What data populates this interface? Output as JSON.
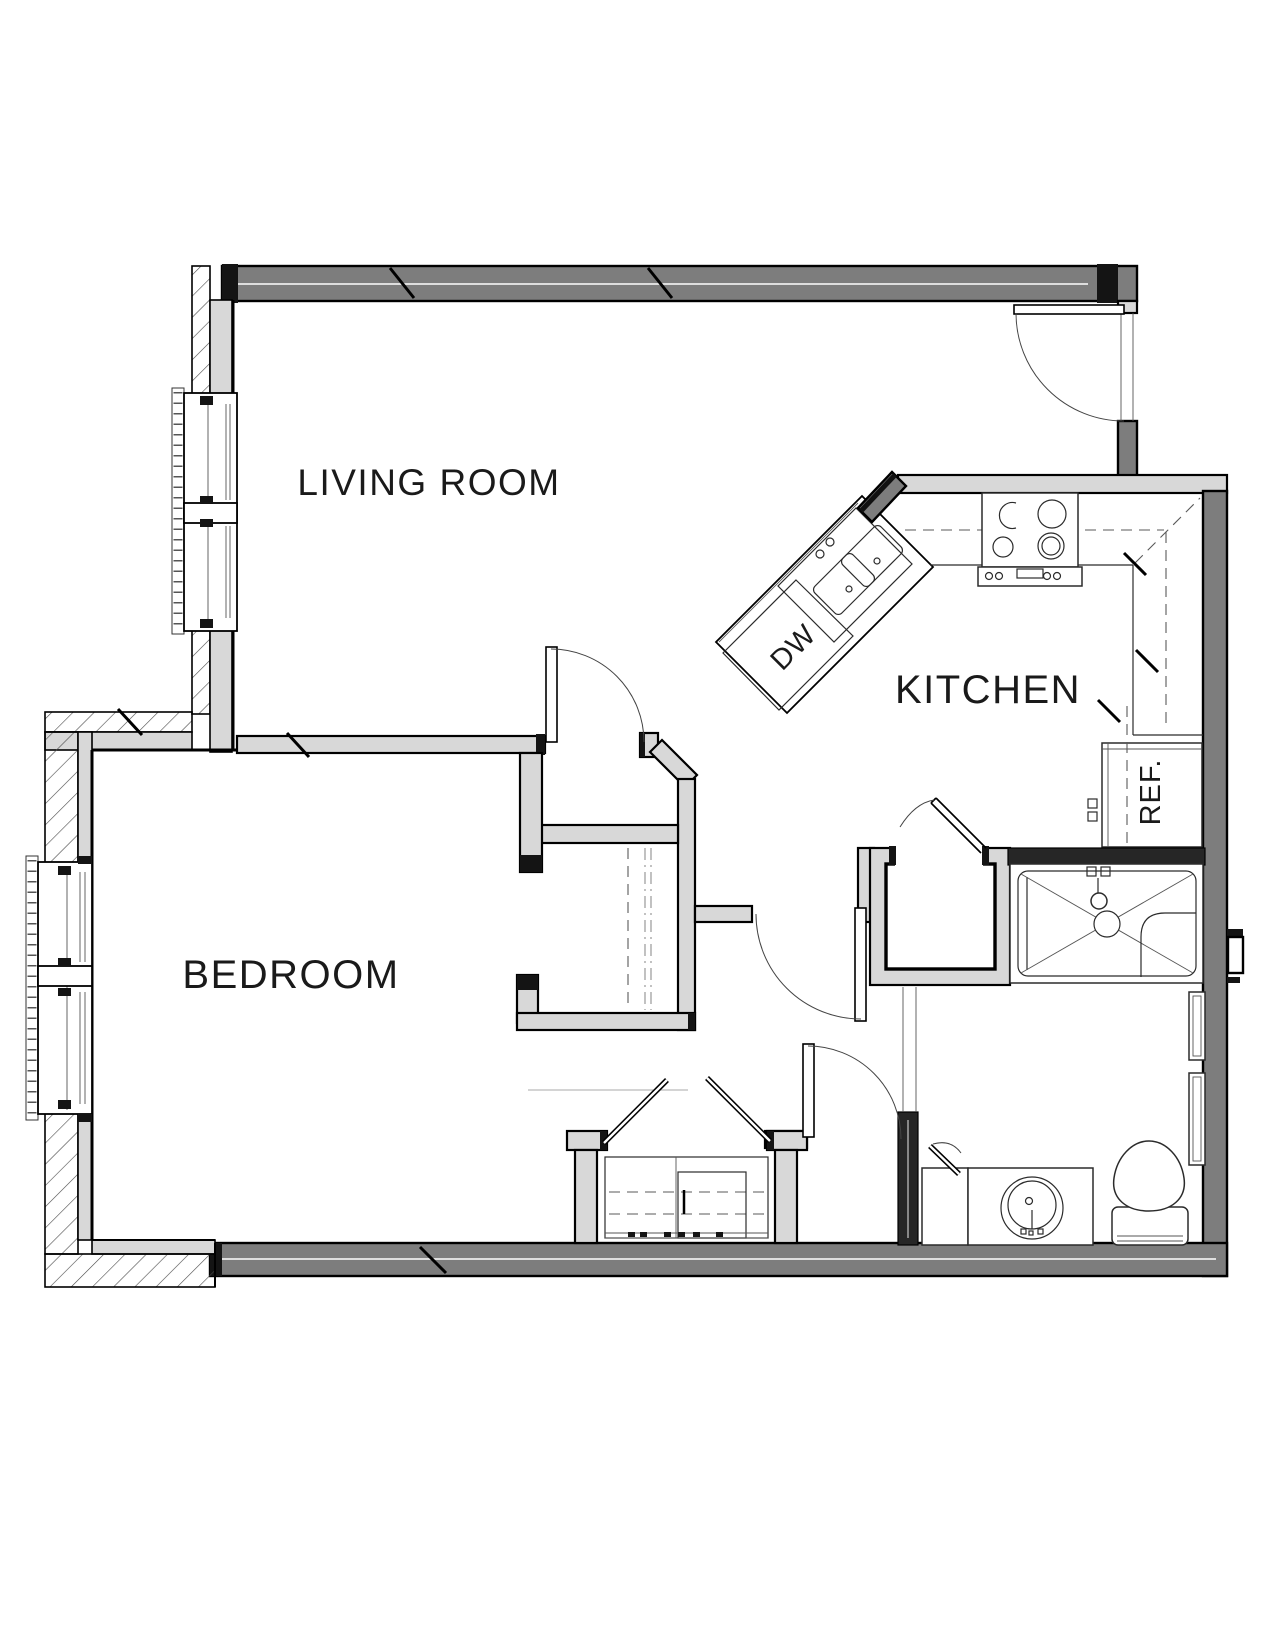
{
  "title": "apartment-floor-plan",
  "rooms": [
    {
      "id": "living-room",
      "label": "LIVING ROOM"
    },
    {
      "id": "kitchen",
      "label": "KITCHEN"
    },
    {
      "id": "bedroom",
      "label": "BEDROOM"
    }
  ],
  "appliances": {
    "dishwasher_label": "DW",
    "refrigerator_label": "REF."
  },
  "fixtures": [
    "entry-door",
    "bedroom-door",
    "hall-door",
    "bathroom-door",
    "utility-closet-door",
    "closet-double-doors",
    "kitchen-island-sink",
    "dishwasher",
    "range-stove",
    "refrigerator",
    "shower",
    "utility-closet",
    "bedroom-closet",
    "linen-niches",
    "vanity-sink",
    "toilet",
    "living-room-window",
    "bedroom-window"
  ],
  "colors": {
    "background": "#ffffff",
    "exterior_wall": "#7d7d7d",
    "interior_wall": "#d8d8d8",
    "solid_wall": "#262626",
    "line": "#1a1a1a"
  }
}
